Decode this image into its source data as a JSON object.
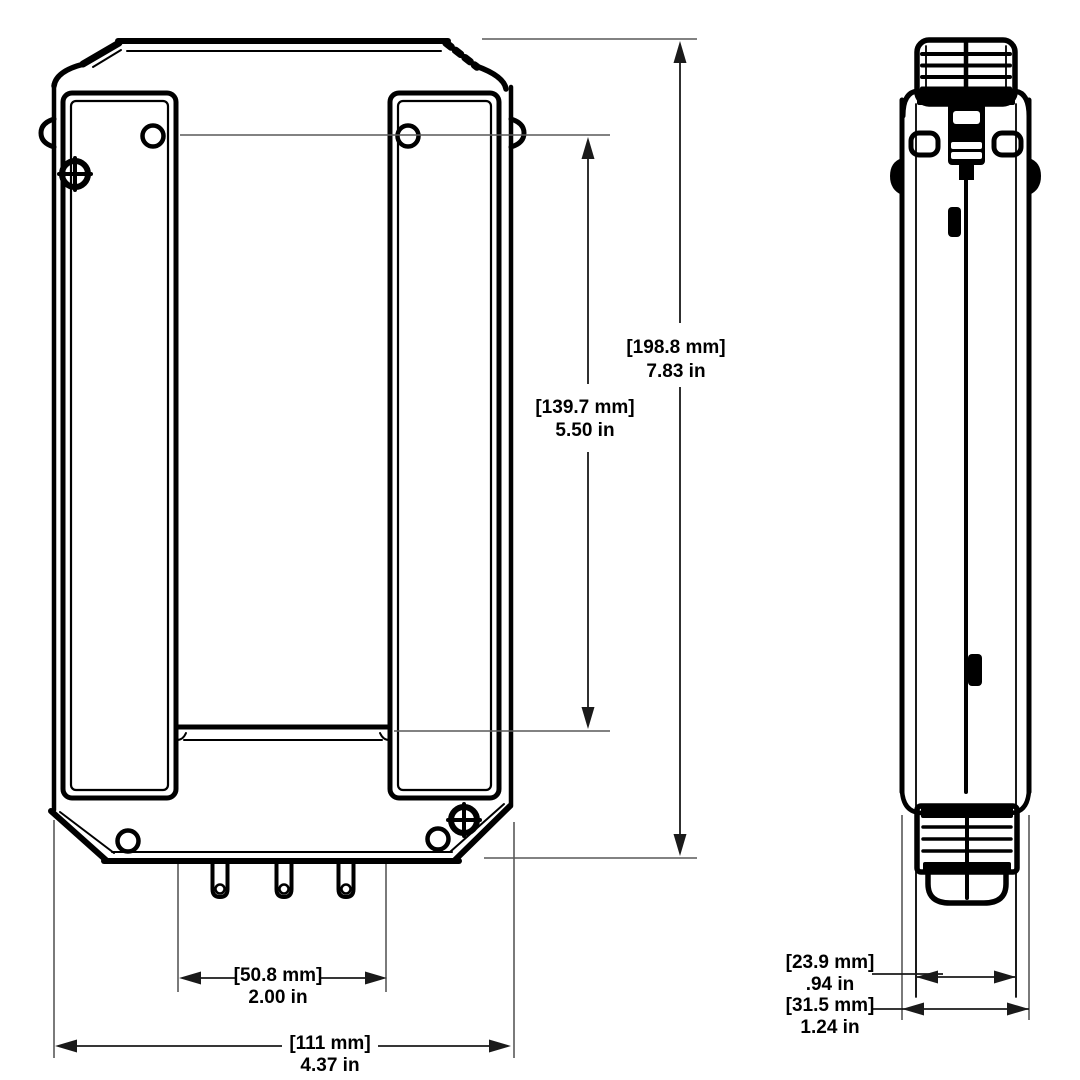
{
  "drawing": {
    "background": "#ffffff",
    "colors": {
      "object_line": "#000000",
      "dimension_line": "#1a1a1a",
      "extension_line": "#595959",
      "text": "#000000"
    },
    "dimensions": {
      "overall_height": {
        "metric": "[198.8 mm]",
        "imperial": "7.83 in"
      },
      "mounting_span": {
        "metric": "[139.7 mm]",
        "imperial": "5.50 in"
      },
      "lower_slot_width": {
        "metric": "[50.8 mm]",
        "imperial": "2.00 in"
      },
      "overall_width": {
        "metric": "[111 mm]",
        "imperial": "4.37 in"
      },
      "side_body_width": {
        "metric": "[23.9 mm]",
        "imperial": ".94 in"
      },
      "side_overall_depth": {
        "metric": "[31.5 mm]",
        "imperial": "1.24 in"
      }
    }
  }
}
